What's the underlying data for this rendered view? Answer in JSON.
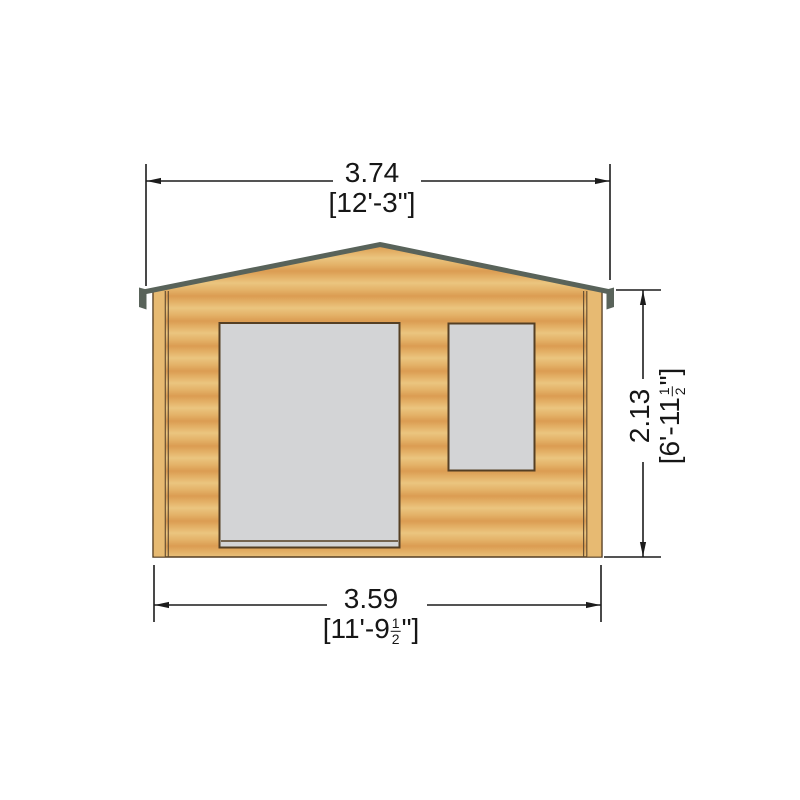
{
  "page": {
    "background": "#ffffff"
  },
  "diagram": {
    "name": "log-cabin-front-elevation-drawing",
    "colors": {
      "wall_light": "#ebc57f",
      "wall_mid": "#e3b066",
      "wall_dark": "#db9c52",
      "trim": "#e7ba72",
      "trim_line": "#6a5133",
      "roof_edge": "#59635a",
      "outline": "#553f24",
      "glazing": "#d3d4d6",
      "dimension_line": "#1c1c1c"
    },
    "dimensions": {
      "overall_width": {
        "metric": "3.74",
        "imperial": "[12'-3\"]"
      },
      "wall_height": {
        "metric": "2.13",
        "imperial_prefix": "[6'-11",
        "fraction_numerator": "1",
        "fraction_denominator": "2",
        "imperial_suffix": "\"]"
      },
      "base_width": {
        "metric": "3.59",
        "imperial_prefix": "[11'-9",
        "fraction_numerator": "1",
        "fraction_denominator": "2",
        "imperial_suffix": "\"]"
      }
    }
  }
}
